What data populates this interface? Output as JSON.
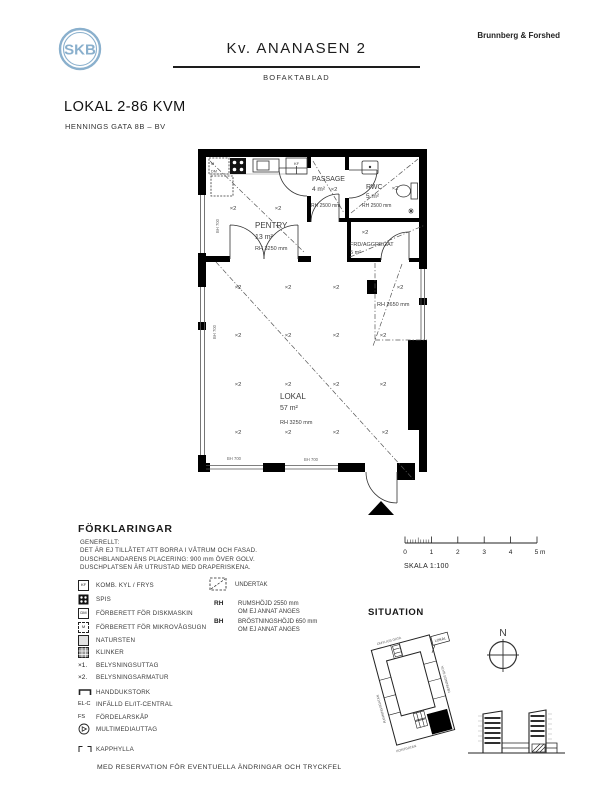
{
  "header": {
    "logo": "SKB",
    "project": "Kv. ANANASEN 2",
    "doc_type": "BOFAKTABLAD",
    "architect": "Brunnberg & Forshed"
  },
  "title_block": {
    "title": "LOKAL 2-86 KVM",
    "address": "HENNINGS GATA 8B – BV"
  },
  "plan": {
    "rooms": {
      "pentry": {
        "name": "PENTRY",
        "area": "13 m²",
        "height": "RH 3250 mm"
      },
      "passage": {
        "name": "PASSAGE",
        "area": "4 m²",
        "height": "RH 2500 mm"
      },
      "rwc": {
        "name": "RWC",
        "area": "5 m²",
        "height": "RH 2500 mm"
      },
      "frd": {
        "name": "FRD/AGGREGAT",
        "area": "5 m²"
      },
      "lokal": {
        "name": "LOKAL",
        "area": "57 m²",
        "height": "RH 3250 mm"
      }
    },
    "annotations": {
      "light_fixture": "×2",
      "ceiling_right": "RH 2650 mm",
      "sill": "BH 700",
      "micro": "M",
      "dishwasher": "DM",
      "fridge_freezer": "KF"
    }
  },
  "legend": {
    "title": "FÖRKLARINGAR",
    "general": [
      "GENERELLT:",
      "DET ÄR EJ TILLÅTET ATT BORRA I VÅTRUM OCH FASAD.",
      "DUSCHBLANDARENS PLACERING: 900 mm ÖVER GOLV.",
      "DUSCHPLATSEN ÄR UTRUSTAD MED DRAPERISKENA."
    ],
    "items": [
      {
        "icon": "fridge-freezer",
        "abbr": "KF",
        "label": "KOMB. KYL / FRYS"
      },
      {
        "icon": "stove",
        "label": "SPIS"
      },
      {
        "icon": "dishwasher",
        "abbr": "DM",
        "label": "FÖRBERETT FÖR DISKMASKIN"
      },
      {
        "icon": "microwave",
        "abbr": "M",
        "label": "FÖRBERETT FÖR MIKROVÅGSUGN"
      },
      {
        "icon": "natural-stone",
        "label": "NATURSTEN"
      },
      {
        "icon": "tile",
        "label": "KLINKER"
      },
      {
        "symbol": "×1.",
        "label": "BELYSNINGSUTTAG"
      },
      {
        "symbol": "×2.",
        "label": "BELYSNINGSARMATUR"
      },
      {
        "icon": "towel-dryer",
        "label": "HANDDUKSTORK"
      },
      {
        "symbol": "EL-C",
        "label": "INFÄLLD EL/IT-CENTRAL"
      },
      {
        "symbol": "FS",
        "label": "FÖRDELARSKÅP"
      },
      {
        "icon": "multimedia",
        "label": "MULTIMEDIAUTTAG"
      },
      {
        "icon": "coat-shelf",
        "label": "KAPPHYLLA"
      }
    ],
    "right": {
      "undertak": "UNDERTAK",
      "rh_abbr": "RH",
      "rh_text": "RUMSHÖJD 2550 mm",
      "rh_note": "OM EJ ANNAT ANGES",
      "bh_abbr": "BH",
      "bh_text": "BRÖSTNINGSHÖJD 650 mm",
      "bh_note": "OM EJ ANNAT ANGES"
    }
  },
  "scale_bar": {
    "ticks": [
      "0",
      "1",
      "2",
      "3",
      "4",
      "5 m"
    ],
    "label": "SKALA 1:100"
  },
  "situation": {
    "title": "SITUATION",
    "north": "N",
    "lokal_tag": "LOKAL",
    "streets": {
      "top": "OMYLIUS GATA",
      "left": "RANNINGSGATAN",
      "right": "HENNINGS GATA",
      "bottom": "KONTGATAN"
    }
  },
  "footer": "MED RESERVATION FÖR EVENTUELLA ÄNDRINGAR OCH TRYCKFEL"
}
